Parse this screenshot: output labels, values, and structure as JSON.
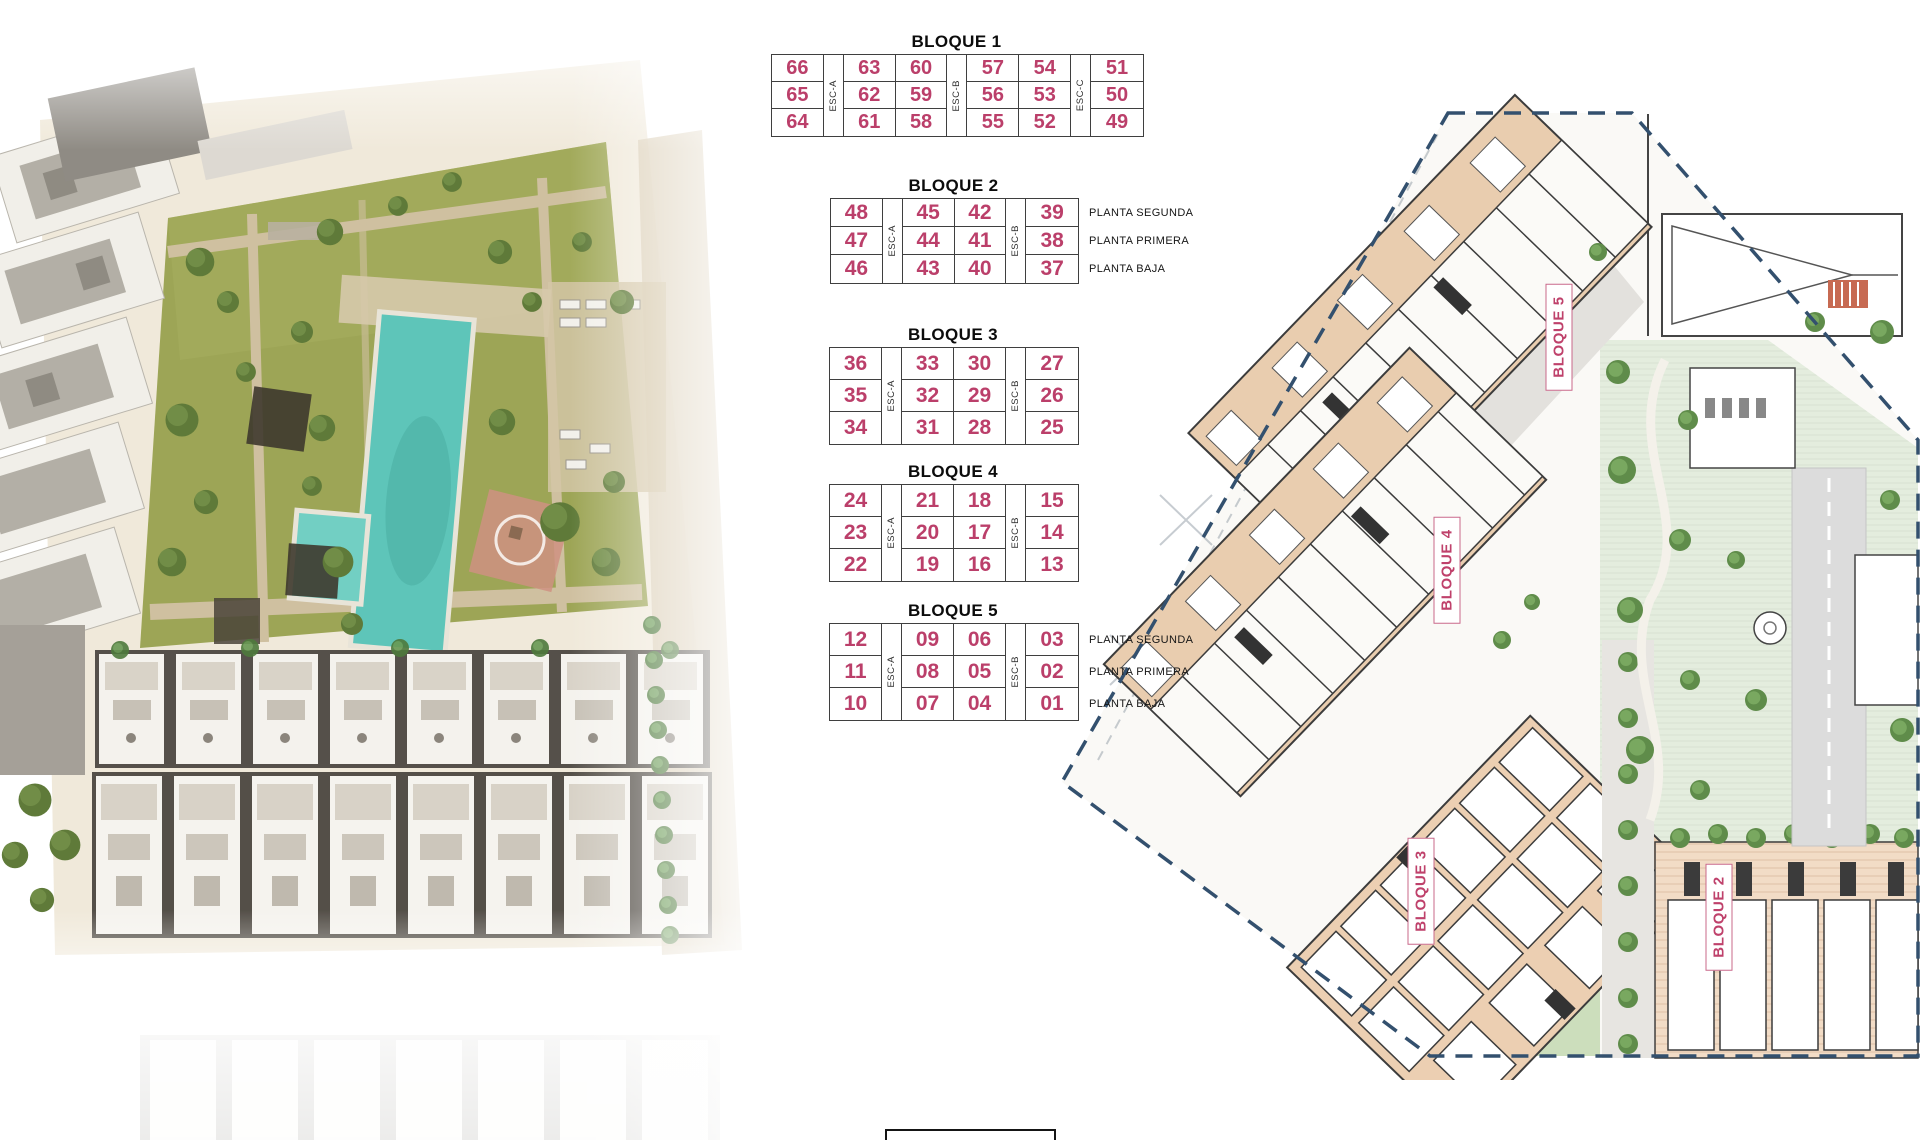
{
  "bloques": [
    {
      "title": "BLOQUE 1",
      "escaleras": [
        "ESC-A",
        "ESC-B",
        "ESC-C"
      ],
      "rows": [
        [
          "66",
          "63",
          "60",
          "57",
          "54",
          "51"
        ],
        [
          "65",
          "62",
          "59",
          "56",
          "53",
          "50"
        ],
        [
          "64",
          "61",
          "58",
          "55",
          "52",
          "49"
        ]
      ],
      "planta_labels": []
    },
    {
      "title": "BLOQUE 2",
      "escaleras": [
        "ESC-A",
        "ESC-B"
      ],
      "rows": [
        [
          "48",
          "45",
          "42",
          "39"
        ],
        [
          "47",
          "44",
          "41",
          "38"
        ],
        [
          "46",
          "43",
          "40",
          "37"
        ]
      ],
      "planta_labels": [
        "PLANTA SEGUNDA",
        "PLANTA PRIMERA",
        "PLANTA BAJA"
      ]
    },
    {
      "title": "BLOQUE 3",
      "escaleras": [
        "ESC-A",
        "ESC-B"
      ],
      "rows": [
        [
          "36",
          "33",
          "30",
          "27"
        ],
        [
          "35",
          "32",
          "29",
          "26"
        ],
        [
          "34",
          "31",
          "28",
          "25"
        ]
      ],
      "planta_labels": []
    },
    {
      "title": "BLOQUE 4",
      "escaleras": [
        "ESC-A",
        "ESC-B"
      ],
      "rows": [
        [
          "24",
          "21",
          "18",
          "15"
        ],
        [
          "23",
          "20",
          "17",
          "14"
        ],
        [
          "22",
          "19",
          "16",
          "13"
        ]
      ],
      "planta_labels": []
    },
    {
      "title": "BLOQUE 5",
      "escaleras": [
        "ESC-A",
        "ESC-B"
      ],
      "rows": [
        [
          "12",
          "09",
          "06",
          "03"
        ],
        [
          "11",
          "08",
          "05",
          "02"
        ],
        [
          "10",
          "07",
          "04",
          "01"
        ]
      ],
      "planta_labels": [
        "PLANTA SEGUNDA",
        "PLANTA PRIMERA",
        "PLANTA BAJA"
      ]
    }
  ],
  "site_plan": {
    "block_labels": [
      "BLOQUE 5",
      "BLOQUE 4",
      "BLOQUE 3",
      "BLOQUE 2"
    ]
  },
  "colors": {
    "unit_number_pink": "#bb3f6a",
    "table_border": "#3f3f3f",
    "title_black": "#0c0c0c",
    "boundary_navy": "#33506e",
    "building_tan": "#e9cdaf",
    "terracotta": "#f2dcc6",
    "communal_green": "#e4edde",
    "tree_green": "#5f7a39",
    "lawn_olive": "#9da556",
    "pool_teal": "#5ec5b9",
    "road_gray": "#dcdcdc"
  }
}
